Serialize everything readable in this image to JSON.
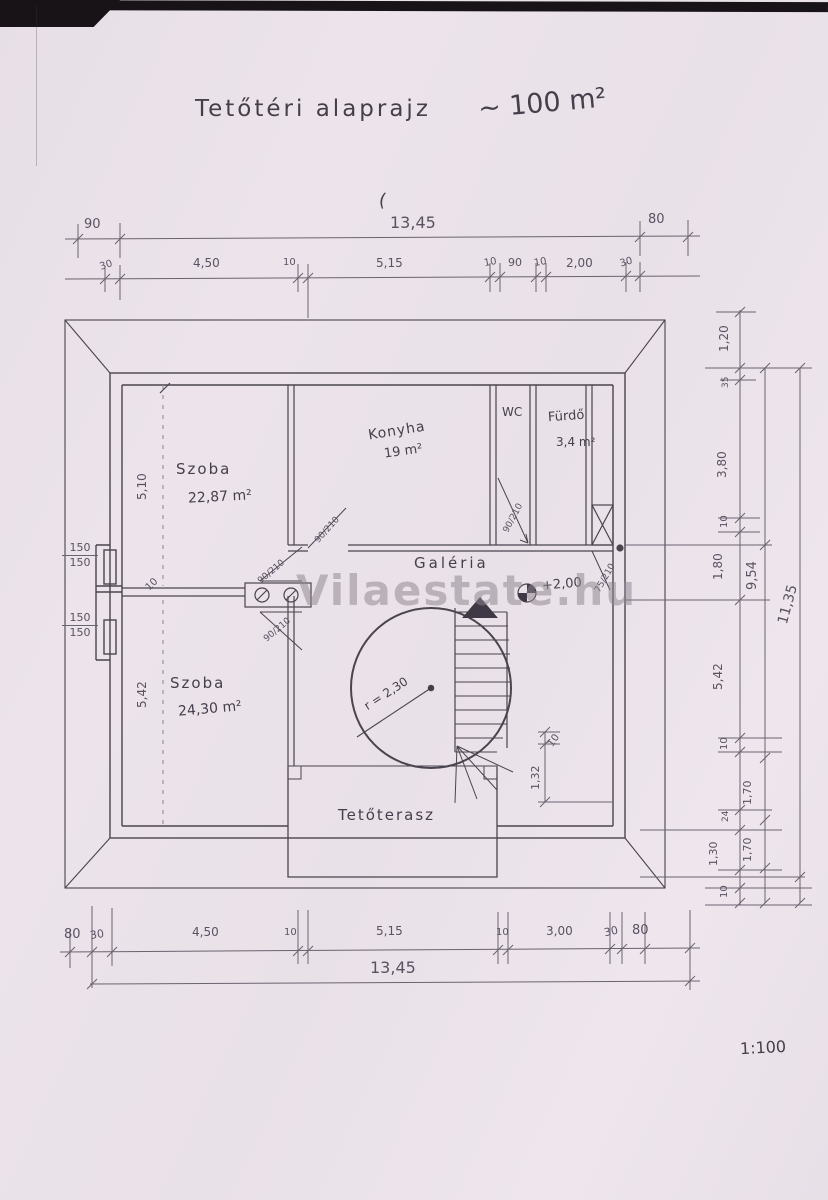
{
  "title": {
    "text": "Tetőtéri alaprajz",
    "area_note": "~ 100 m²"
  },
  "watermark": "Vilaestate.hu",
  "scale_note": "1:100",
  "stray_mark": "(",
  "rooms": {
    "szoba_top": {
      "name": "Szoba",
      "area": "22,87 m²"
    },
    "konyha": {
      "name": "Konyha",
      "area": "19 m²"
    },
    "wc": {
      "name": "WC"
    },
    "furdo": {
      "name": "Fürdő",
      "area": "3,4 m²"
    },
    "galeria": {
      "name": "Galéria"
    },
    "szoba_bottom": {
      "name": "Szoba",
      "area": "24,30 m²"
    },
    "terasz": {
      "name": "Tetőterasz"
    }
  },
  "stair": {
    "radius": "r = 2,30",
    "elevation": "+2,00"
  },
  "dims": {
    "top_total_left": "90",
    "top_total": "13,45",
    "top_total_right": "80",
    "top_row": [
      "30",
      "4,50",
      "10",
      "5,15",
      "10",
      "90",
      "10",
      "2,00",
      "30"
    ],
    "bottom_row": [
      "80",
      "30",
      "4,50",
      "10",
      "5,15",
      "10",
      "3,00",
      "30",
      "80"
    ],
    "bottom_total": "13,45",
    "right_inner": [
      "1,20",
      "35",
      "3,80",
      "10",
      "1,80",
      "5,42",
      "10",
      "24",
      "1,30",
      "10"
    ],
    "right_middle": [
      "9,54",
      "1,70",
      "1,70"
    ],
    "right_outer": "11,35",
    "left_upper": "5,10",
    "left_lower": "5,42",
    "window_upper": {
      "top": "150",
      "bottom": "150"
    },
    "window_lower": {
      "top": "150",
      "bottom": "150"
    },
    "terrace": {
      "a": "1,32",
      "b": "10"
    },
    "wall_tick": "10",
    "doors": {
      "galeria_top": "90/210",
      "galeria_bottom": "90/210",
      "konyha": "90/210",
      "wc": "90/210",
      "right": "75/210"
    }
  }
}
